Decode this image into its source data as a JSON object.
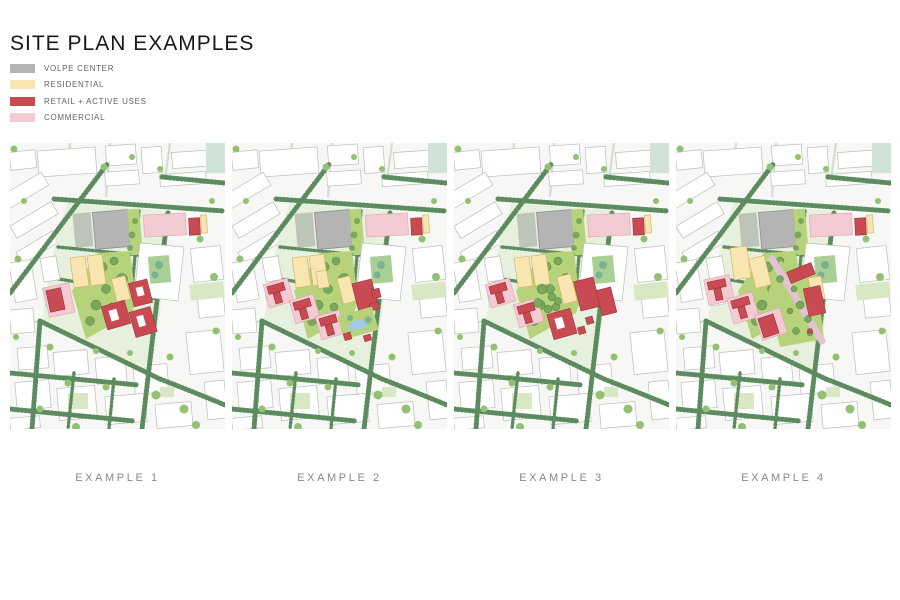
{
  "title": "SITE PLAN EXAMPLES",
  "legend": {
    "items": [
      {
        "id": "volpe",
        "label": "VOLPE CENTER",
        "color": "#b4b4b5"
      },
      {
        "id": "residential",
        "label": "RESIDENTIAL",
        "color": "#f8e5b0"
      },
      {
        "id": "retail",
        "label": "RETAIL + ACTIVE USES",
        "color": "#c94a52"
      },
      {
        "id": "commercial",
        "label": "COMMERCIAL",
        "color": "#f4cbd2"
      }
    ]
  },
  "examples": [
    {
      "label": "EXAMPLE 1"
    },
    {
      "label": "EXAMPLE 2"
    },
    {
      "label": "EXAMPLE 3"
    },
    {
      "label": "EXAMPLE 4"
    }
  ],
  "map_colors": {
    "bg": "#f7f8f5",
    "bstroke": "#b9bfb7",
    "street": "#5d8b60",
    "road": "#d6dbd3",
    "site": "#e7efdd",
    "park": "#b6d37c",
    "lawn": "#d9e7c4",
    "tlawn": "#cfe3d8",
    "court": "#a9cf97",
    "canopy": "#7aa85a",
    "canopy2": "#93c072",
    "teal": "#79b28f",
    "pond": "#a6c9e3",
    "path": "#e2c3d4",
    "plaza": "#9aa29a"
  }
}
